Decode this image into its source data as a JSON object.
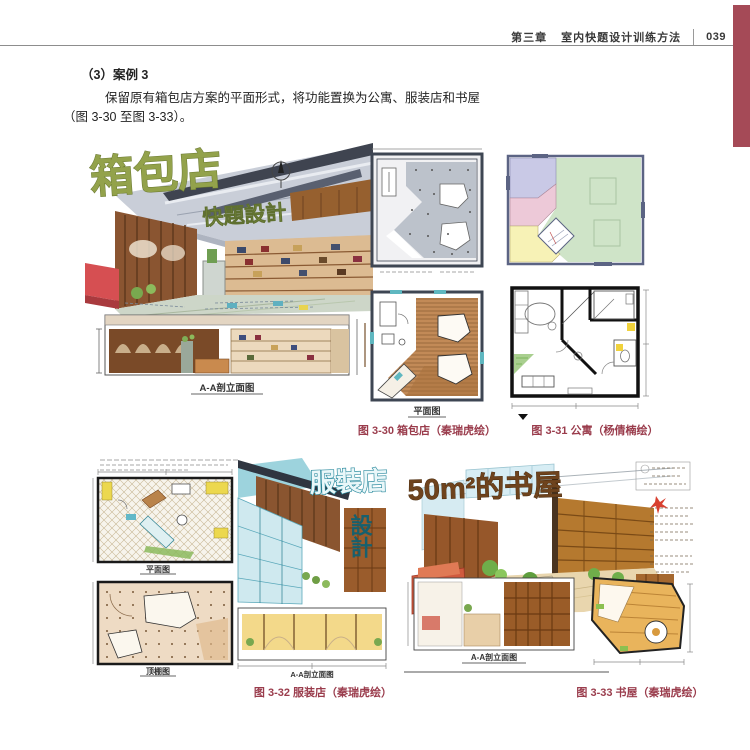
{
  "header": {
    "chapter": "第三章",
    "title": "室内快题设计训练方法",
    "page_number": "039"
  },
  "content": {
    "case_heading": "（3）案例 3",
    "body_line1": "保留原有箱包店方案的平面形式，将功能置换为公寓、服装店和书屋",
    "body_line2": "（图 3-30 至图 3-33）。"
  },
  "figures": {
    "fig_3_30": {
      "caption": "图 3-30 箱包店（秦瑞虎绘）",
      "title_graffiti": "箱包店",
      "subtitle_graffiti": "快題設計",
      "plan_label": "平面图",
      "elevation_label": "A-A剖立面图"
    },
    "fig_3_31": {
      "caption": "图 3-31 公寓（杨倩楠绘）"
    },
    "fig_3_32": {
      "caption": "图 3-32 服装店（秦瑞虎绘）",
      "title_graffiti": "服裝店",
      "subtitle_graffiti": "設計",
      "plan_label": "平面图",
      "ceiling_label": "顶棚图",
      "elevation_label": "A-A剖立面图"
    },
    "fig_3_33": {
      "caption": "图 3-33 书屋（秦瑞虎绘）",
      "title_graffiti": "50m²的书屋",
      "elevation_label": "A-A剖立面图"
    }
  },
  "colors": {
    "accent_red_tab": "#a54a57",
    "caption_maroon": "#9a3c4c",
    "graffiti_green": "#93a24b",
    "graffiti_teal": "#2a8a9e",
    "wood_brown": "#8a5531"
  }
}
